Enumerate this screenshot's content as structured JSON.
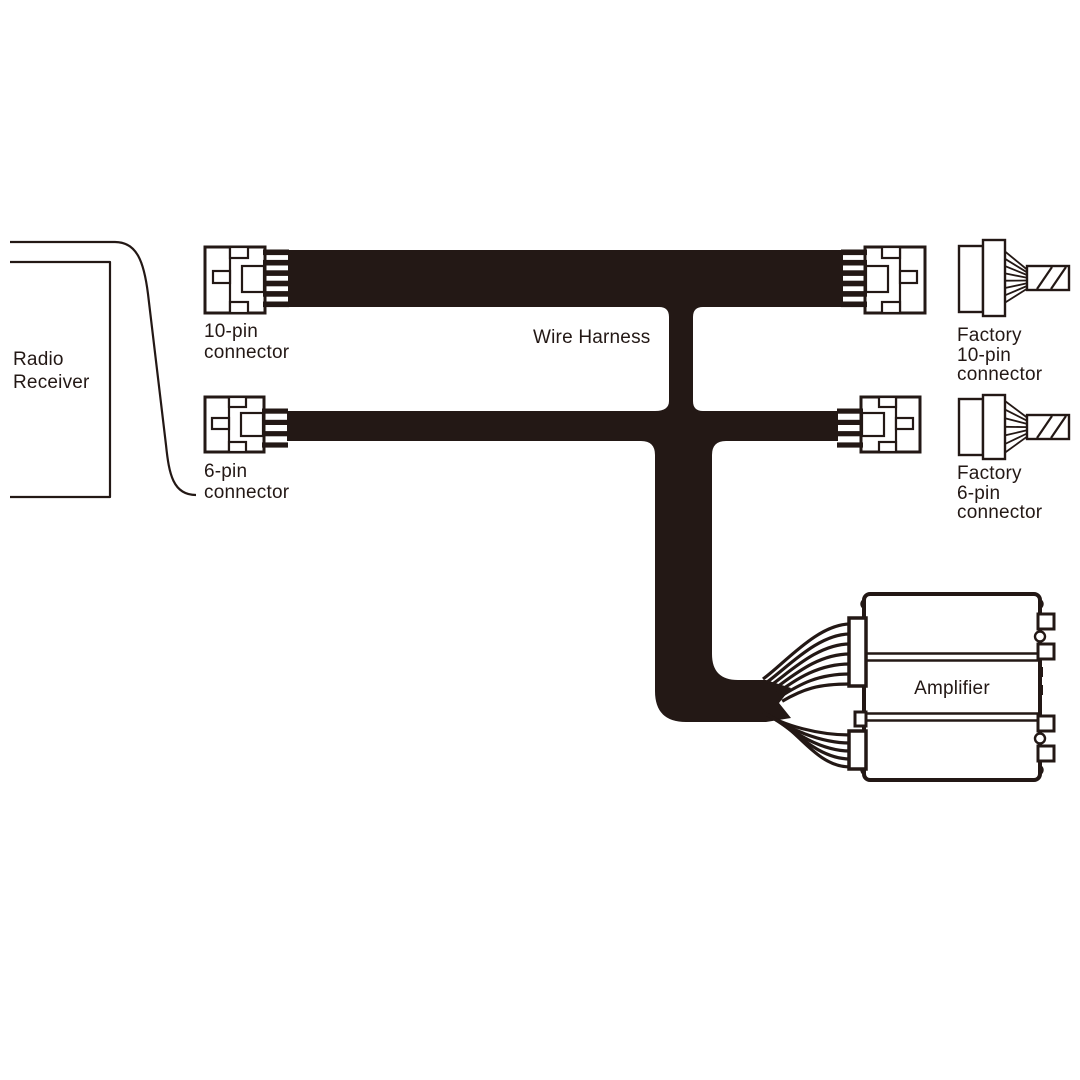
{
  "colors": {
    "ink": "#231815",
    "background": "#ffffff"
  },
  "diagram": {
    "radio_receiver": {
      "label": "Radio\nReceiver"
    },
    "wire_harness": {
      "label": "Wire Harness"
    },
    "connector_10pin": {
      "label": "10-pin\nconnector"
    },
    "connector_6pin": {
      "label": "6-pin\nconnector"
    },
    "factory_10pin": {
      "label": "Factory\n10-pin\nconnector"
    },
    "factory_6pin": {
      "label": "Factory\n6-pin\nconnector"
    },
    "amplifier": {
      "label": "Amplifier"
    }
  }
}
